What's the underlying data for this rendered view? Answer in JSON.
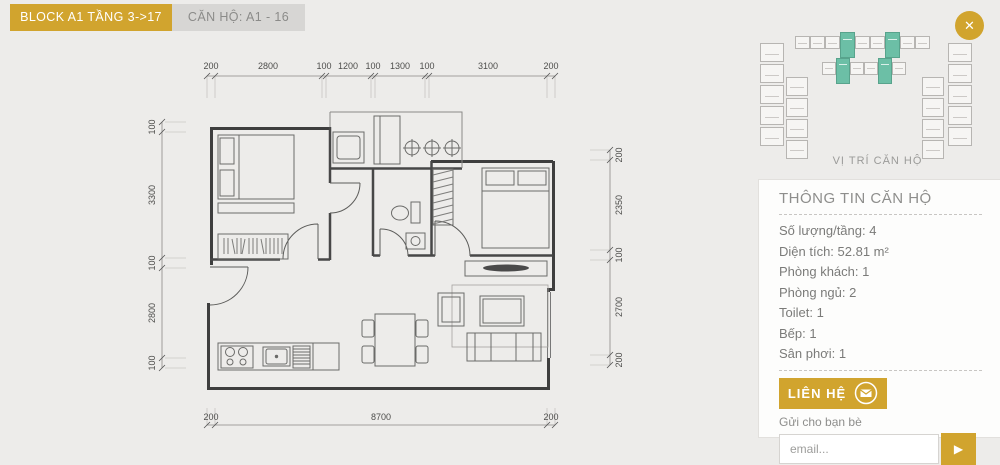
{
  "colors": {
    "gold": "#d1a42e",
    "teal": "#6cbfa6",
    "background": "#edecea",
    "panel": "#fdfdfc",
    "wall_line": "#3e3e3e"
  },
  "header": {
    "block_tab": "BLOCK A1 TẦNG 3->17",
    "unit_tab": "CĂN HỘ: A1 - 16"
  },
  "close_button": {
    "glyph": "✕"
  },
  "minimap": {
    "caption": "VỊ TRÍ CĂN HỘ"
  },
  "plan": {
    "dims": {
      "top": [
        "200",
        "2800",
        "100",
        "1200",
        "100",
        "1300",
        "100",
        "3100",
        "200"
      ],
      "left": [
        "100",
        "3300",
        "100",
        "2800",
        "100"
      ],
      "right": [
        "200",
        "2350",
        "100",
        "2700",
        "200"
      ],
      "bottom": [
        "200",
        "8700",
        "200"
      ]
    }
  },
  "info_panel": {
    "title": "THÔNG TIN CĂN HỘ",
    "rows": [
      "Số lượng/tầng: 4",
      "Diện tích: 52.81 m²",
      "Phòng khách: 1",
      "Phòng ngủ: 2",
      "Toilet: 1",
      "Bếp: 1",
      "Sân phơi: 1"
    ],
    "contact_button": "LIÊN HỆ",
    "share_label": "Gửi cho bạn bè",
    "email_placeholder": "email...",
    "send_glyph": "▶"
  }
}
